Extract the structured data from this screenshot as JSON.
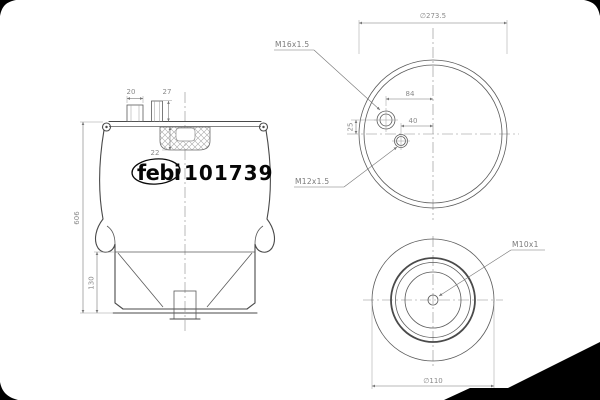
{
  "drawing": {
    "brand_label": "febi",
    "part_number": "101739",
    "side_view": {
      "stud_width": "20",
      "stud_height": "27",
      "bumper_depth": "22",
      "overall_height": "606",
      "piston_height": "130"
    },
    "top_view": {
      "outer_diameter": "∅273.5",
      "stud_thread": "M16x1.5",
      "stud_offset_x": "84",
      "port_offset_x": "40",
      "stud_offset_y": "25",
      "port_thread": "M12x1.5"
    },
    "bottom_view": {
      "center_thread": "M10x1",
      "base_diameter": "∅110"
    },
    "colors": {
      "line": "#4a4a4a",
      "dimension": "#8a8a8a",
      "brand_text": "#060606",
      "corner_marks": "#000000"
    }
  }
}
